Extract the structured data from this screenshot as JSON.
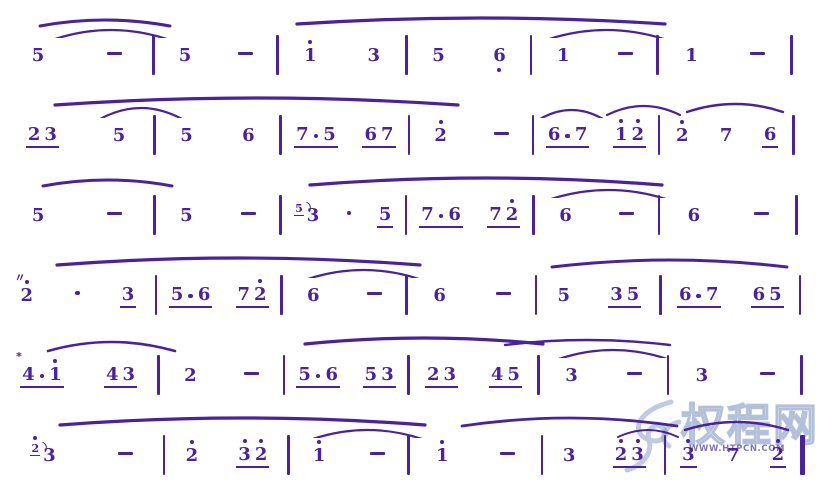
{
  "page": {
    "background": "#ffffff",
    "ink_color": "#4a21a0",
    "watermark_color": "#8498c0"
  },
  "watermark": {
    "site_name": "权程网",
    "url": "WWW.HTPCN.COM"
  },
  "systems": [
    {
      "w": [
        18.6,
        14.8,
        15.5,
        14.9,
        15.1,
        16.1
      ],
      "measures": [
        [
          {
            "tk": [
              {
                "k": "n",
                "t": "5"
              }
            ]
          },
          {
            "tk": [
              {
                "k": "-"
              }
            ]
          }
        ],
        [
          {
            "tk": [
              {
                "k": "n",
                "t": "5"
              }
            ]
          },
          {
            "tk": [
              {
                "k": "-"
              }
            ]
          }
        ],
        [
          {
            "tk": [
              {
                "k": "n",
                "t": "1",
                "da": 1
              }
            ]
          },
          {
            "tk": [
              {
                "k": "n",
                "t": "3"
              }
            ]
          }
        ],
        [
          {
            "tk": [
              {
                "k": "n",
                "t": "5"
              }
            ]
          },
          {
            "tk": [
              {
                "k": "n",
                "t": "6",
                "db": 1
              }
            ]
          }
        ],
        [
          {
            "tk": [
              {
                "k": "n",
                "t": "1"
              }
            ]
          },
          {
            "tk": [
              {
                "k": "-"
              }
            ]
          }
        ],
        [
          {
            "tk": [
              {
                "k": "n",
                "t": "1"
              }
            ]
          },
          {
            "tk": [
              {
                "k": "-"
              }
            ]
          }
        ]
      ],
      "slurs": [
        {
          "x1": 40,
          "x2": 170,
          "y": 16,
          "d": 6,
          "sw": 3
        },
        {
          "x1": 52,
          "x2": 170,
          "y": 26,
          "d": 10,
          "sw": 2.2
        },
        {
          "x1": 297,
          "x2": 665,
          "y": 14,
          "d": 6,
          "sw": 3.2
        },
        {
          "x1": 543,
          "x2": 670,
          "y": 26,
          "d": 11,
          "sw": 2.2
        }
      ]
    },
    {
      "w": [
        18.7,
        15.1,
        15.4,
        14.8,
        15.1,
        16.1
      ],
      "measures": [
        [
          {
            "u": 1,
            "tk": [
              {
                "k": "n",
                "t": "2"
              },
              {
                "k": "n",
                "t": "3"
              }
            ]
          },
          {
            "tk": [
              {
                "k": "n",
                "t": "5"
              }
            ]
          }
        ],
        [
          {
            "tk": [
              {
                "k": "n",
                "t": "5"
              }
            ]
          },
          {
            "tk": [
              {
                "k": "n",
                "t": "6"
              }
            ]
          }
        ],
        [
          {
            "u": 1,
            "tk": [
              {
                "k": "n",
                "t": "7"
              },
              {
                "k": "."
              },
              {
                "k": "n",
                "t": "5"
              }
            ]
          },
          {
            "u": 1,
            "tk": [
              {
                "k": "n",
                "t": "6"
              },
              {
                "k": "n",
                "t": "7"
              }
            ]
          }
        ],
        [
          {
            "tk": [
              {
                "k": "n",
                "t": "2",
                "da": 1
              }
            ]
          },
          {
            "tk": [
              {
                "k": "-"
              }
            ]
          }
        ],
        [
          {
            "u": 1,
            "tk": [
              {
                "k": "n",
                "t": "6"
              },
              {
                "k": "."
              },
              {
                "k": "n",
                "t": "7"
              }
            ]
          },
          {
            "u": 1,
            "tk": [
              {
                "k": "n",
                "t": "1",
                "da": 1
              },
              {
                "k": "n",
                "t": "2",
                "da": 1
              }
            ]
          }
        ],
        [
          {
            "tk": [
              {
                "k": "n",
                "t": "2",
                "da": 1
              }
            ]
          },
          {
            "tk": [
              {
                "k": "n",
                "t": "7"
              }
            ]
          },
          {
            "u": 1,
            "tk": [
              {
                "k": "n",
                "t": "6"
              }
            ]
          }
        ]
      ],
      "slurs": [
        {
          "x1": 55,
          "x2": 458,
          "y": 14,
          "d": 7,
          "sw": 3.2
        },
        {
          "x1": 100,
          "x2": 182,
          "y": 24,
          "d": 11,
          "sw": 2.2
        },
        {
          "x1": 540,
          "x2": 603,
          "y": 26,
          "d": 9,
          "sw": 2.2
        },
        {
          "x1": 607,
          "x2": 680,
          "y": 22,
          "d": 9,
          "sw": 2.2
        },
        {
          "x1": 687,
          "x2": 783,
          "y": 20,
          "d": 8,
          "sw": 2.4
        }
      ]
    },
    {
      "w": [
        18.7,
        15.1,
        15.0,
        15.3,
        15.0,
        16.5
      ],
      "measures": [
        [
          {
            "tk": [
              {
                "k": "n",
                "t": "5"
              }
            ]
          },
          {
            "tk": [
              {
                "k": "-"
              }
            ]
          }
        ],
        [
          {
            "tk": [
              {
                "k": "n",
                "t": "5"
              }
            ]
          },
          {
            "tk": [
              {
                "k": "-"
              }
            ]
          }
        ],
        [
          {
            "tk": [
              {
                "k": "n",
                "t": "5",
                "g": 1
              },
              {
                "k": "n",
                "t": "3"
              }
            ]
          },
          {
            "tk": [
              {
                "k": "."
              }
            ]
          },
          {
            "u": 1,
            "tk": [
              {
                "k": "n",
                "t": "5"
              }
            ]
          }
        ],
        [
          {
            "u": 1,
            "tk": [
              {
                "k": "n",
                "t": "7"
              },
              {
                "k": "."
              },
              {
                "k": "n",
                "t": "6"
              }
            ]
          },
          {
            "u": 1,
            "tk": [
              {
                "k": "n",
                "t": "7"
              },
              {
                "k": "n",
                "t": "2",
                "da": 1
              }
            ]
          }
        ],
        [
          {
            "tk": [
              {
                "k": "n",
                "t": "6"
              }
            ]
          },
          {
            "tk": [
              {
                "k": "-"
              }
            ]
          }
        ],
        [
          {
            "tk": [
              {
                "k": "n",
                "t": "6"
              }
            ]
          },
          {
            "tk": [
              {
                "k": "-"
              }
            ]
          }
        ]
      ],
      "slurs": [
        {
          "x1": 43,
          "x2": 172,
          "y": 16,
          "d": 6,
          "sw": 3
        },
        {
          "x1": 310,
          "x2": 662,
          "y": 14,
          "d": 7,
          "sw": 3.2
        },
        {
          "x1": 545,
          "x2": 672,
          "y": 26,
          "d": 11,
          "sw": 2.2
        }
      ]
    },
    {
      "w": [
        18.9,
        15.0,
        15.0,
        15.5,
        14.9,
        16.7
      ],
      "measures": [
        [
          {
            "tk": [
              {
                "k": "n",
                "t": "2",
                "da": 1,
                "orn": "〃"
              }
            ]
          },
          {
            "tk": [
              {
                "k": "."
              }
            ]
          },
          {
            "u": 1,
            "tk": [
              {
                "k": "n",
                "t": "3"
              }
            ]
          }
        ],
        [
          {
            "u": 1,
            "tk": [
              {
                "k": "n",
                "t": "5"
              },
              {
                "k": "."
              },
              {
                "k": "n",
                "t": "6"
              }
            ]
          },
          {
            "u": 1,
            "tk": [
              {
                "k": "n",
                "t": "7"
              },
              {
                "k": "n",
                "t": "2",
                "da": 1
              }
            ]
          }
        ],
        [
          {
            "tk": [
              {
                "k": "n",
                "t": "6"
              }
            ]
          },
          {
            "tk": [
              {
                "k": "-"
              }
            ]
          }
        ],
        [
          {
            "tk": [
              {
                "k": "n",
                "t": "6"
              }
            ]
          },
          {
            "tk": [
              {
                "k": "-"
              }
            ]
          }
        ],
        [
          {
            "tk": [
              {
                "k": "n",
                "t": "5"
              }
            ]
          },
          {
            "u": 1,
            "tk": [
              {
                "k": "n",
                "t": "3"
              },
              {
                "k": "n",
                "t": "5"
              }
            ]
          }
        ],
        [
          {
            "u": 1,
            "tk": [
              {
                "k": "n",
                "t": "6"
              },
              {
                "k": "."
              },
              {
                "k": "n",
                "t": "7"
              }
            ]
          },
          {
            "u": 1,
            "tk": [
              {
                "k": "n",
                "t": "6"
              },
              {
                "k": "n",
                "t": "5"
              }
            ]
          }
        ]
      ],
      "slurs": [
        {
          "x1": 57,
          "x2": 420,
          "y": 14,
          "d": 7,
          "sw": 3.2
        },
        {
          "x1": 302,
          "x2": 425,
          "y": 26,
          "d": 11,
          "sw": 2.2
        },
        {
          "x1": 552,
          "x2": 787,
          "y": 16,
          "d": 7,
          "sw": 3
        }
      ]
    },
    {
      "w": [
        19.2,
        15.0,
        14.9,
        15.6,
        15.5,
        16.0
      ],
      "measures": [
        [
          {
            "u": 1,
            "tk": [
              {
                "k": "n",
                "t": "4",
                "orn": "*"
              },
              {
                "k": "."
              },
              {
                "k": "n",
                "t": "1",
                "da": 1
              }
            ]
          },
          {
            "u": 1,
            "tk": [
              {
                "k": "n",
                "t": "4"
              },
              {
                "k": "n",
                "t": "3"
              }
            ]
          }
        ],
        [
          {
            "tk": [
              {
                "k": "n",
                "t": "2"
              }
            ]
          },
          {
            "tk": [
              {
                "k": "-"
              }
            ]
          }
        ],
        [
          {
            "u": 1,
            "tk": [
              {
                "k": "n",
                "t": "5"
              },
              {
                "k": "."
              },
              {
                "k": "n",
                "t": "6"
              }
            ]
          },
          {
            "u": 1,
            "tk": [
              {
                "k": "n",
                "t": "5"
              },
              {
                "k": "n",
                "t": "3"
              }
            ]
          }
        ],
        [
          {
            "u": 1,
            "tk": [
              {
                "k": "n",
                "t": "2"
              },
              {
                "k": "n",
                "t": "3"
              }
            ]
          },
          {
            "u": 1,
            "tk": [
              {
                "k": "n",
                "t": "4"
              },
              {
                "k": "n",
                "t": "5"
              }
            ]
          }
        ],
        [
          {
            "tk": [
              {
                "k": "n",
                "t": "3"
              }
            ]
          },
          {
            "tk": [
              {
                "k": "-"
              }
            ]
          }
        ],
        [
          {
            "tk": [
              {
                "k": "n",
                "t": "3"
              }
            ]
          },
          {
            "tk": [
              {
                "k": "-"
              }
            ]
          }
        ]
      ],
      "slurs": [
        {
          "x1": 48,
          "x2": 175,
          "y": 18,
          "d": 9,
          "sw": 2.6
        },
        {
          "x1": 305,
          "x2": 543,
          "y": 14,
          "d": 6,
          "sw": 3.2
        },
        {
          "x1": 505,
          "x2": 670,
          "y": 16,
          "d": 5,
          "sw": 2.4
        },
        {
          "x1": 553,
          "x2": 673,
          "y": 26,
          "d": 11,
          "sw": 2.2
        }
      ]
    },
    {
      "w": [
        19.9,
        14.9,
        14.3,
        16.0,
        14.7,
        16.4
      ],
      "final": true,
      "measures": [
        [
          {
            "tk": [
              {
                "k": "n",
                "t": "2",
                "da": 1,
                "g": 1
              },
              {
                "k": "n",
                "t": "3"
              }
            ]
          },
          {
            "tk": [
              {
                "k": "-"
              }
            ]
          }
        ],
        [
          {
            "tk": [
              {
                "k": "n",
                "t": "2",
                "da": 1
              }
            ]
          },
          {
            "u": 1,
            "tk": [
              {
                "k": "n",
                "t": "3",
                "da": 1
              },
              {
                "k": "n",
                "t": "2",
                "da": 1
              }
            ]
          }
        ],
        [
          {
            "tk": [
              {
                "k": "n",
                "t": "1",
                "da": 1
              }
            ]
          },
          {
            "tk": [
              {
                "k": "-"
              }
            ]
          }
        ],
        [
          {
            "tk": [
              {
                "k": "n",
                "t": "1",
                "da": 1
              }
            ]
          },
          {
            "tk": [
              {
                "k": "-"
              }
            ]
          }
        ],
        [
          {
            "tk": [
              {
                "k": "n",
                "t": "3"
              }
            ]
          },
          {
            "u": 1,
            "tk": [
              {
                "k": "n",
                "t": "2",
                "da": 1
              },
              {
                "k": "n",
                "t": "3",
                "da": 1
              }
            ]
          }
        ],
        [
          {
            "u": 1,
            "tk": [
              {
                "k": "n",
                "t": "3",
                "da": 1
              }
            ]
          },
          {
            "tk": [
              {
                "k": "n",
                "t": "7"
              }
            ]
          },
          {
            "u": 1,
            "tk": [
              {
                "k": "n",
                "t": "2",
                "da": 1
              }
            ]
          }
        ]
      ],
      "slurs": [
        {
          "x1": 60,
          "x2": 425,
          "y": 14,
          "d": 7,
          "sw": 3.2
        },
        {
          "x1": 307,
          "x2": 428,
          "y": 26,
          "d": 11,
          "sw": 2.2
        },
        {
          "x1": 462,
          "x2": 677,
          "y": 14,
          "d": 8,
          "sw": 2.8
        },
        {
          "x1": 618,
          "x2": 678,
          "y": 26,
          "d": 7,
          "sw": 2
        },
        {
          "x1": 685,
          "x2": 788,
          "y": 18,
          "d": 8,
          "sw": 2.4
        }
      ]
    }
  ]
}
